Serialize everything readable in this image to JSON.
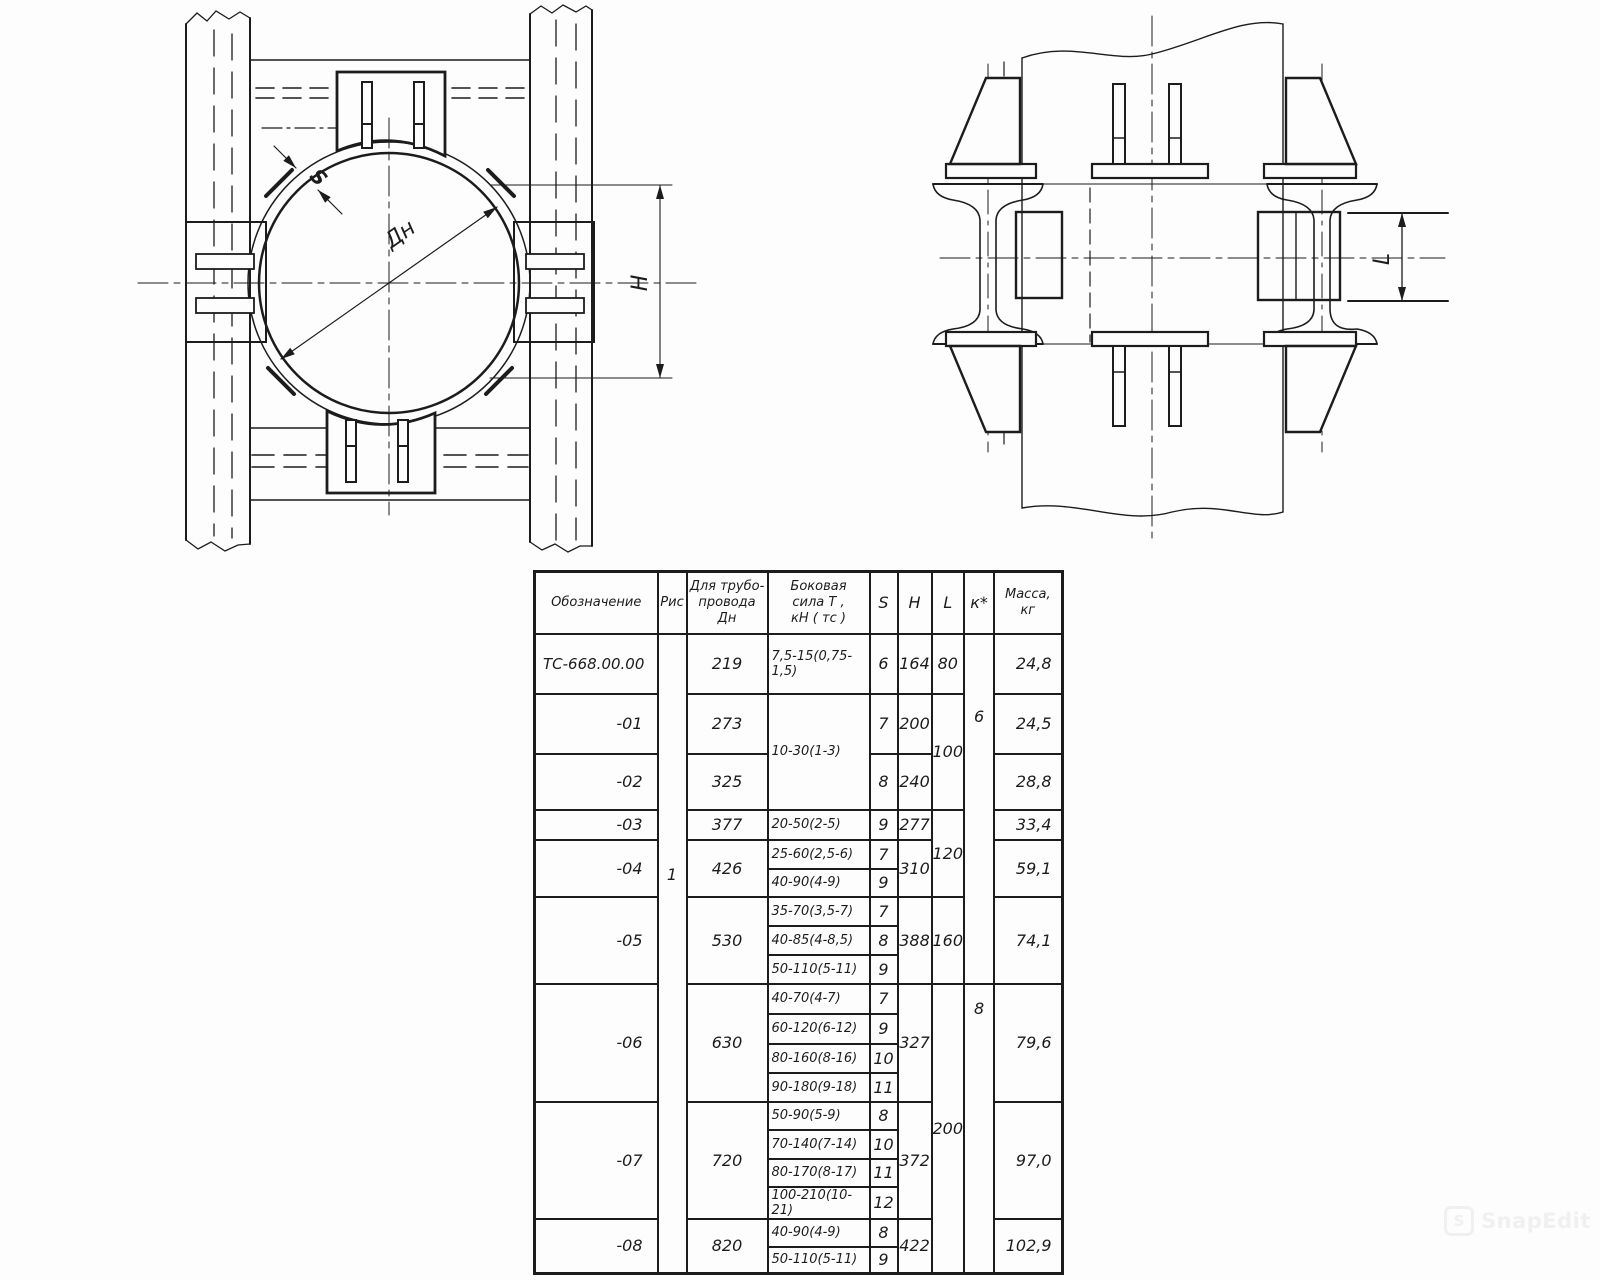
{
  "page": {
    "background": "#fdfdfd",
    "ink": "#1c1c1c",
    "watermark": {
      "icon": "S",
      "text": "SnapEdit"
    }
  },
  "drawing": {
    "left_view": {
      "labels": {
        "wall": "S",
        "diameter": "Дн",
        "height": "H"
      }
    },
    "right_view": {
      "labels": {
        "length": "L"
      }
    }
  },
  "table": {
    "headers": {
      "designation": "Обозначение",
      "fig": "Рис",
      "pipe": "Для трубо-\nпровода\nДн",
      "force": "Боковая\nсила Т ,\nкН ( тс )",
      "s": "S",
      "h": "H",
      "l": "L",
      "k": "к*",
      "mass": "Масса,\nкг"
    },
    "rows": [
      {
        "h": 60,
        "cells": [
          {
            "t": "ТС-668.00.00",
            "cls": "left"
          },
          {
            "t": "1",
            "rs": 19,
            "cls": "fig"
          },
          {
            "t": "219"
          },
          {
            "t": "7,5-15(0,75-1,5)",
            "cls": "force"
          },
          {
            "t": "6"
          },
          {
            "t": "164"
          },
          {
            "t": "80"
          },
          {
            "t": "6",
            "rs": 9,
            "cls": "ktop"
          },
          {
            "t": "24,8",
            "cls": "mass"
          }
        ]
      },
      {
        "h": 60,
        "cells": [
          {
            "t": "-01",
            "cls": "right"
          },
          {
            "t": "273"
          },
          {
            "t": "10-30(1-3)",
            "rs": 2,
            "cls": "force"
          },
          {
            "t": "7"
          },
          {
            "t": "200"
          },
          {
            "t": "100",
            "rs": 2
          },
          {
            "t": "24,5",
            "cls": "mass"
          }
        ]
      },
      {
        "h": 56,
        "cells": [
          {
            "t": "-02",
            "cls": "right"
          },
          {
            "t": "325"
          },
          {
            "t": "8"
          },
          {
            "t": "240"
          },
          {
            "t": "28,8",
            "cls": "mass"
          }
        ]
      },
      {
        "h": 30,
        "cells": [
          {
            "t": "-03",
            "cls": "right"
          },
          {
            "t": "377"
          },
          {
            "t": "20-50(2-5)",
            "cls": "force"
          },
          {
            "t": "9"
          },
          {
            "t": "277"
          },
          {
            "t": "120",
            "rs": 3
          },
          {
            "t": "33,4",
            "cls": "mass"
          }
        ]
      },
      {
        "h": 29,
        "cells": [
          {
            "t": "-04",
            "rs": 2,
            "cls": "right"
          },
          {
            "t": "426",
            "rs": 2
          },
          {
            "t": "25-60(2,5-6)",
            "cls": "force"
          },
          {
            "t": "7"
          },
          {
            "t": "310",
            "rs": 2
          },
          {
            "t": "59,1",
            "rs": 2,
            "cls": "mass"
          }
        ]
      },
      {
        "h": 28,
        "cells": [
          {
            "t": "40-90(4-9)",
            "cls": "force"
          },
          {
            "t": "9"
          }
        ]
      },
      {
        "h": 29,
        "cells": [
          {
            "t": "-05",
            "rs": 3,
            "cls": "right"
          },
          {
            "t": "530",
            "rs": 3
          },
          {
            "t": "35-70(3,5-7)",
            "cls": "force"
          },
          {
            "t": "7"
          },
          {
            "t": "388",
            "rs": 3
          },
          {
            "t": "160",
            "rs": 3
          },
          {
            "t": "74,1",
            "rs": 3,
            "cls": "mass"
          }
        ]
      },
      {
        "h": 29,
        "cells": [
          {
            "t": "40-85(4-8,5)",
            "cls": "force"
          },
          {
            "t": "8"
          }
        ]
      },
      {
        "h": 29,
        "cells": [
          {
            "t": "50-110(5-11)",
            "cls": "force"
          },
          {
            "t": "9"
          }
        ]
      },
      {
        "h": 30,
        "cells": [
          {
            "t": "-06",
            "rs": 4,
            "cls": "right"
          },
          {
            "t": "630",
            "rs": 4
          },
          {
            "t": "40-70(4-7)",
            "cls": "force"
          },
          {
            "t": "7"
          },
          {
            "t": "327",
            "rs": 4
          },
          {
            "t": "200",
            "rs": 10
          },
          {
            "t": "8",
            "rs": 10,
            "cls": "ktop2"
          },
          {
            "t": "79,6",
            "rs": 4,
            "cls": "mass"
          }
        ]
      },
      {
        "h": 30,
        "cells": [
          {
            "t": "60-120(6-12)",
            "cls": "force"
          },
          {
            "t": "9"
          }
        ]
      },
      {
        "h": 29,
        "cells": [
          {
            "t": "80-160(8-16)",
            "cls": "force"
          },
          {
            "t": "10"
          }
        ]
      },
      {
        "h": 29,
        "cells": [
          {
            "t": "90-180(9-18)",
            "cls": "force"
          },
          {
            "t": "11"
          }
        ]
      },
      {
        "h": 28,
        "cells": [
          {
            "t": "-07",
            "rs": 4,
            "cls": "right"
          },
          {
            "t": "720",
            "rs": 4
          },
          {
            "t": "50-90(5-9)",
            "cls": "force"
          },
          {
            "t": "8"
          },
          {
            "t": "372",
            "rs": 4
          },
          {
            "t": "97,0",
            "rs": 4,
            "cls": "mass"
          }
        ]
      },
      {
        "h": 29,
        "cells": [
          {
            "t": "70-140(7-14)",
            "cls": "force"
          },
          {
            "t": "10"
          }
        ]
      },
      {
        "h": 28,
        "cells": [
          {
            "t": "80-170(8-17)",
            "cls": "force"
          },
          {
            "t": "11"
          }
        ]
      },
      {
        "h": 28,
        "cells": [
          {
            "t": "100-210(10-21)",
            "cls": "force"
          },
          {
            "t": "12"
          }
        ]
      },
      {
        "h": 28,
        "cells": [
          {
            "t": "-08",
            "rs": 2,
            "cls": "right"
          },
          {
            "t": "820",
            "rs": 2
          },
          {
            "t": "40-90(4-9)",
            "cls": "force"
          },
          {
            "t": "8"
          },
          {
            "t": "422",
            "rs": 2
          },
          {
            "t": "102,9",
            "rs": 2,
            "cls": "mass"
          }
        ]
      },
      {
        "h": 27,
        "cells": [
          {
            "t": "50-110(5-11)",
            "cls": "force"
          },
          {
            "t": "9"
          }
        ]
      }
    ]
  }
}
